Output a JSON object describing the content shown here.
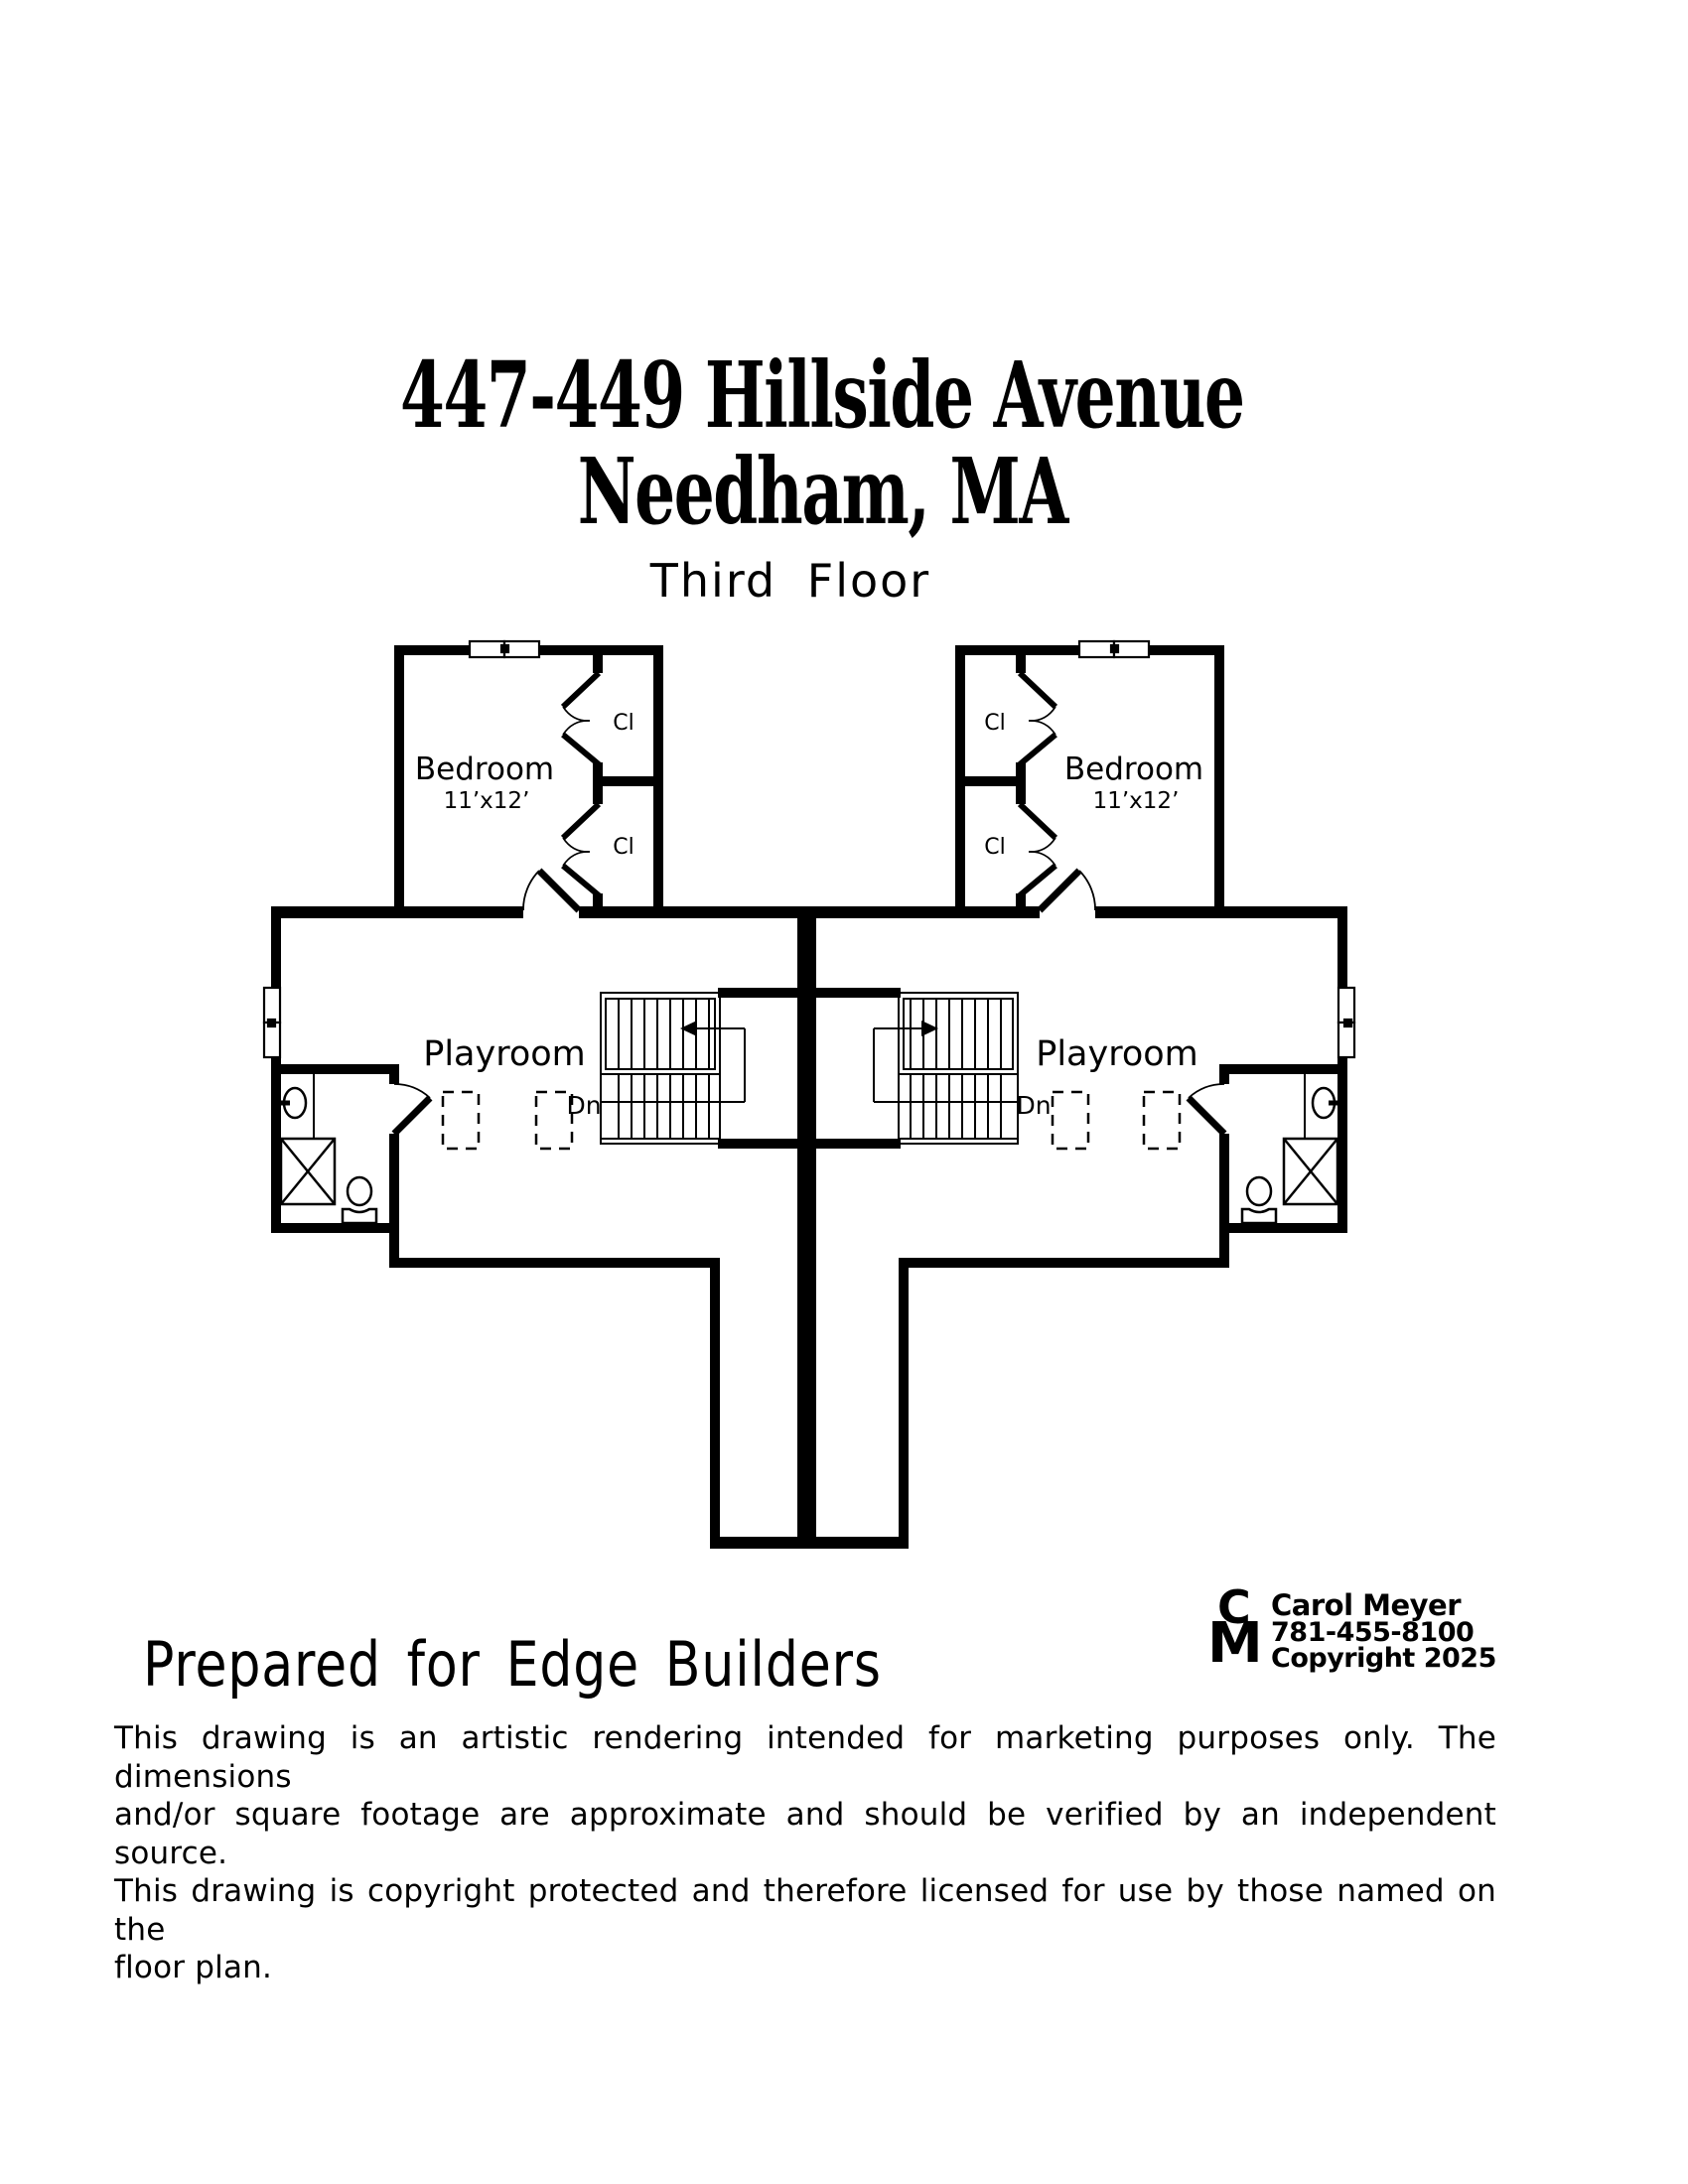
{
  "colors": {
    "ink": "#000000",
    "paper": "#ffffff"
  },
  "title": {
    "line1": "447-449 Hillside Avenue",
    "line2": "Needham, MA",
    "subtitle": "Third Floor"
  },
  "plan": {
    "bedroom_label": "Bedroom",
    "bedroom_dims": "11’x12’",
    "closet_label": "Cl",
    "playroom_label": "Playroom",
    "down_label": "Dn"
  },
  "footer": {
    "prepared_for": "Prepared for Edge Builders",
    "logo": {
      "initial_c": "C",
      "initial_m": "M",
      "name": "Carol Meyer",
      "phone": "781-455-8100",
      "copyright": "Copyright 2025"
    },
    "disclaimer_lines": [
      "This drawing is an artistic rendering intended for marketing purposes only.  The dimensions",
      "and/or square footage are approximate and should be verified by an independent source.",
      "This drawing is copyright protected and therefore licensed for use by those named on the",
      "floor plan."
    ]
  }
}
